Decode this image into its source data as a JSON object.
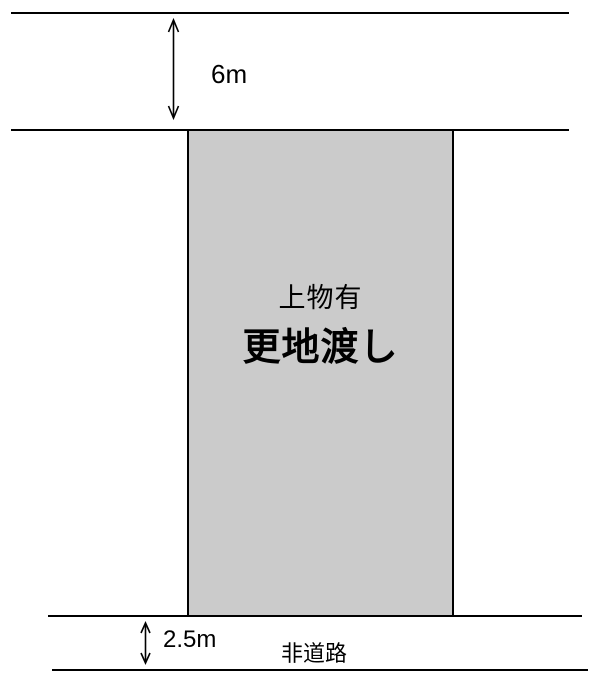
{
  "diagram": {
    "type": "land-plot-dimension-diagram",
    "top_road": {
      "width_label": "6m"
    },
    "plot": {
      "condition_label": "上物有",
      "delivery_label": "更地渡し"
    },
    "bottom_strip": {
      "width_label": "2.5m",
      "name_label": "非道路"
    },
    "colors": {
      "background": "#ffffff",
      "line": "#000000",
      "text": "#000000",
      "plot_fill": "#cbcbcb"
    }
  }
}
